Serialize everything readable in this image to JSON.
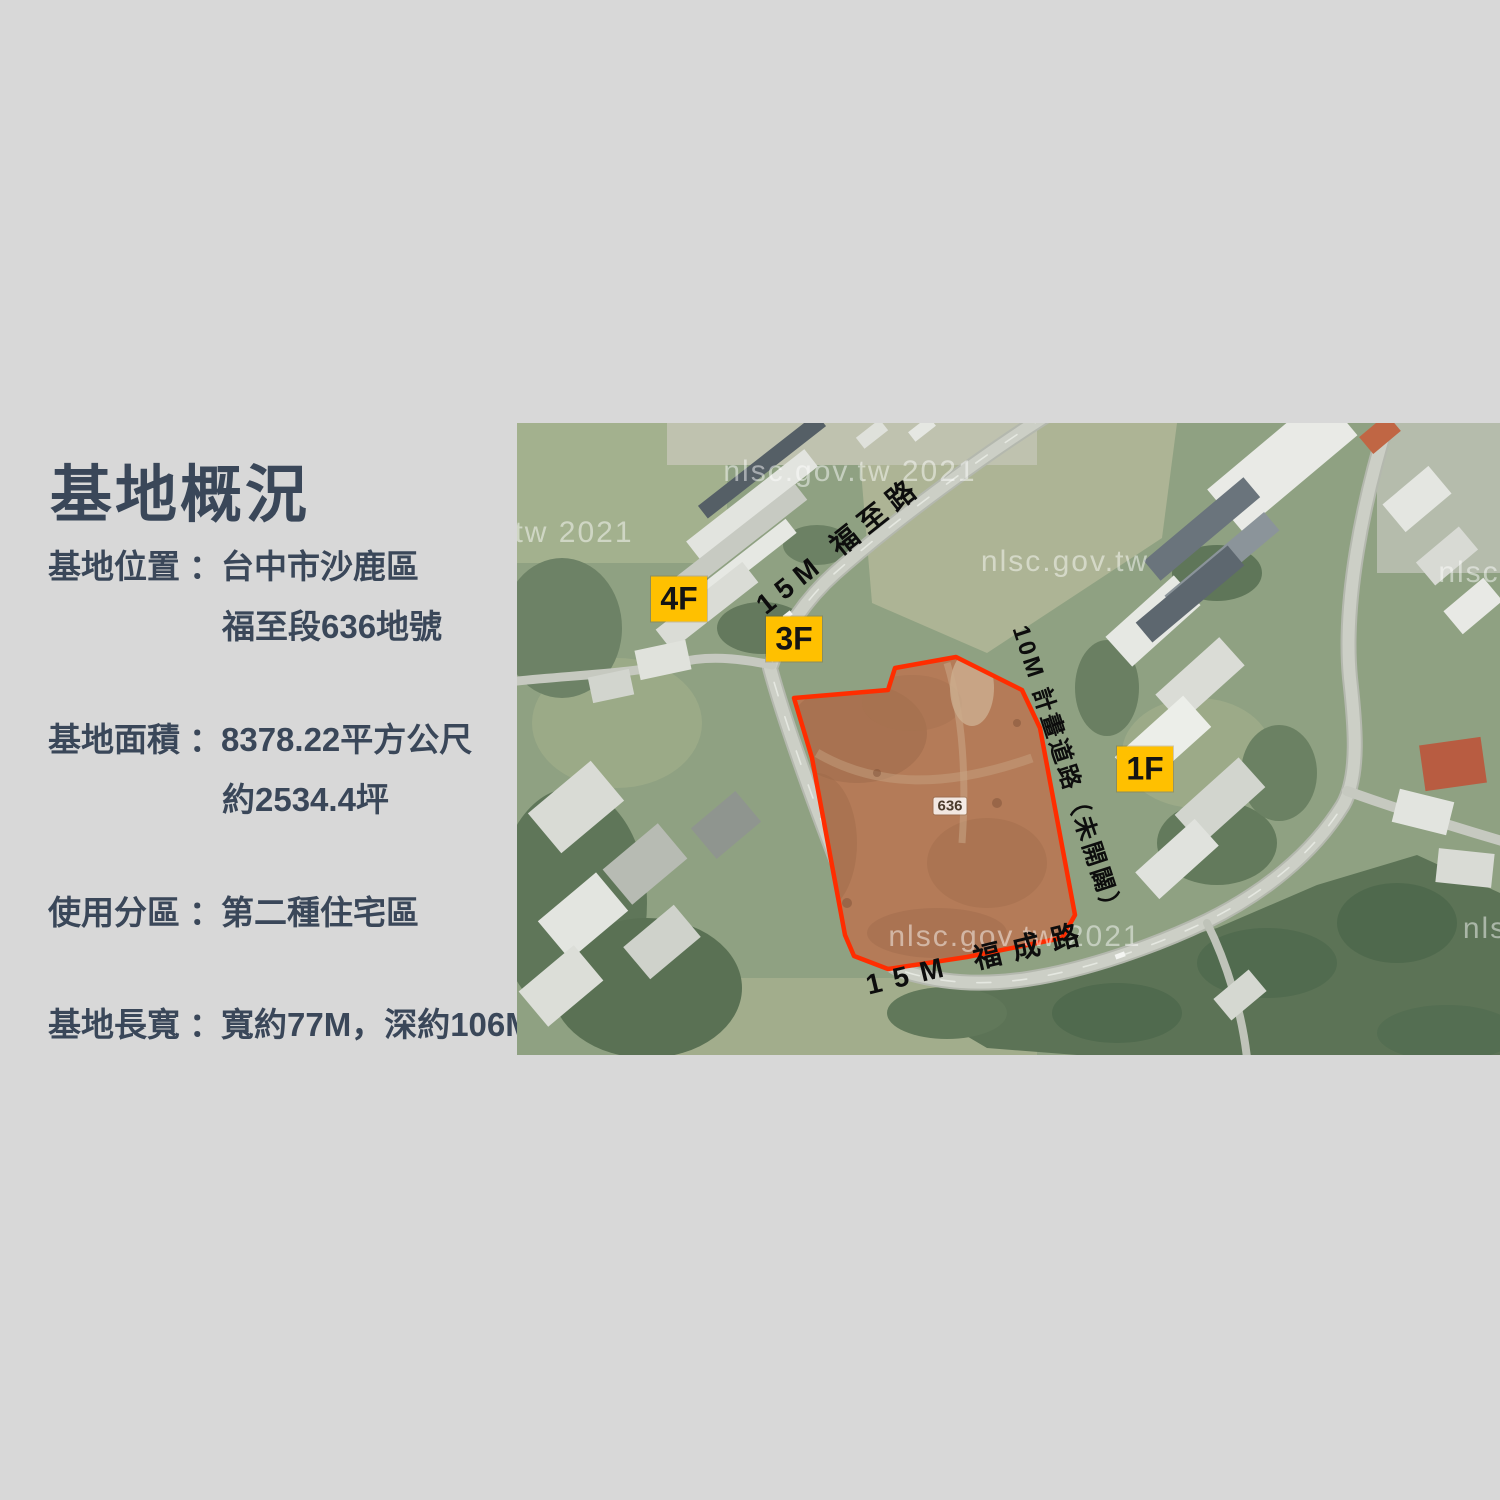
{
  "panel": {
    "title": "基地概況",
    "rows": [
      {
        "label": "基地位置",
        "colon": "：",
        "line1": "台中市沙鹿區",
        "line2": "福至段636地號"
      },
      {
        "label": "基地面積",
        "colon": "：",
        "line1": "8378.22平方公尺",
        "line2": "約2534.4坪"
      },
      {
        "label": "使用分區",
        "colon": "：",
        "line1": "第二種住宅區",
        "line2": ""
      },
      {
        "label": "基地長寬",
        "colon": "：",
        "line1": "寬約77M，深約106M",
        "line2": ""
      }
    ],
    "text_color": "#3a4759"
  },
  "map": {
    "road_labels": {
      "fuzhi": "15M 福至路",
      "planned": "10M 計畫道路（未開闢）",
      "fucheng": "15M 福成路"
    },
    "badges": [
      {
        "text": "4F"
      },
      {
        "text": "3F"
      },
      {
        "text": "1F"
      }
    ],
    "parcel_tag": "636",
    "watermarks": [
      "nlsc.gov.tw 2021",
      "tw 2021",
      "nlsc.gov.tw",
      "nlsc.gov.tw 2021",
      "nlsc",
      "nls"
    ],
    "badge_color": "#ffc000",
    "site_outline_color": "#ff2d00",
    "site_fill_color": "#b47b58",
    "background_color": "#d8d8d8"
  }
}
